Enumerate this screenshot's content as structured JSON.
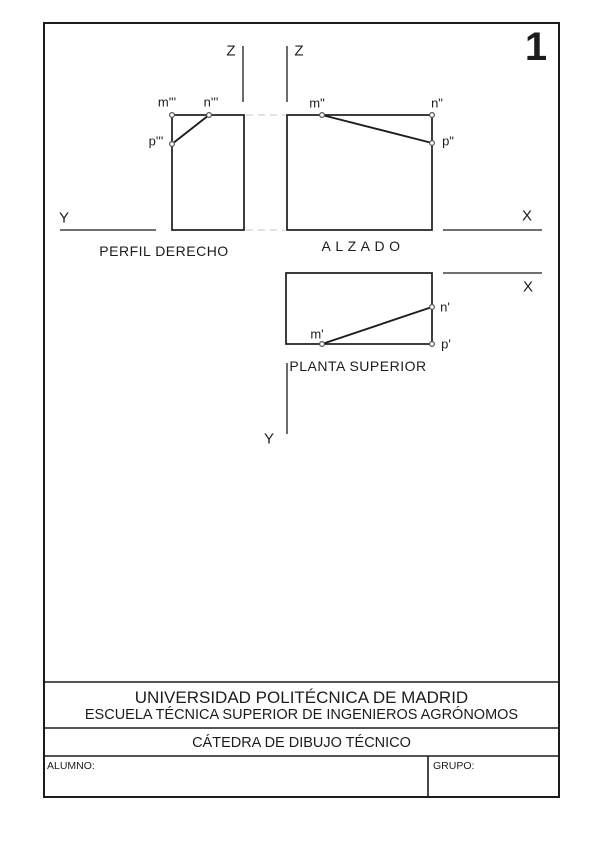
{
  "sheet": {
    "number": "1",
    "axes": {
      "z_left": "Z",
      "z_right": "Z",
      "y_left": "Y",
      "x_alzado": "X",
      "x_planta": "X",
      "y_planta": "Y"
    },
    "views": {
      "perfil": {
        "caption": "PERFIL DERECHO",
        "m": "m'''",
        "n": "n'''",
        "p": "p'''"
      },
      "alzado": {
        "caption": "ALZADO",
        "m": "m\"",
        "n": "n\"",
        "p": "p\""
      },
      "planta": {
        "caption": "PLANTA SUPERIOR",
        "m": "m'",
        "n": "n'",
        "p": "p'"
      }
    },
    "title_block": {
      "line1": "UNIVERSIDAD POLITÉCNICA DE MADRID",
      "line2": "ESCUELA TÉCNICA SUPERIOR DE INGENIEROS AGRÓNOMOS",
      "line3": "CÁTEDRA DE DIBUJO TÉCNICO",
      "alumno_label": "ALUMNO:",
      "grupo_label": "GRUPO:"
    },
    "colors": {
      "ink": "#1c1c1c",
      "faint_line": "#c6c6c6",
      "paper": "#ffffff"
    }
  }
}
